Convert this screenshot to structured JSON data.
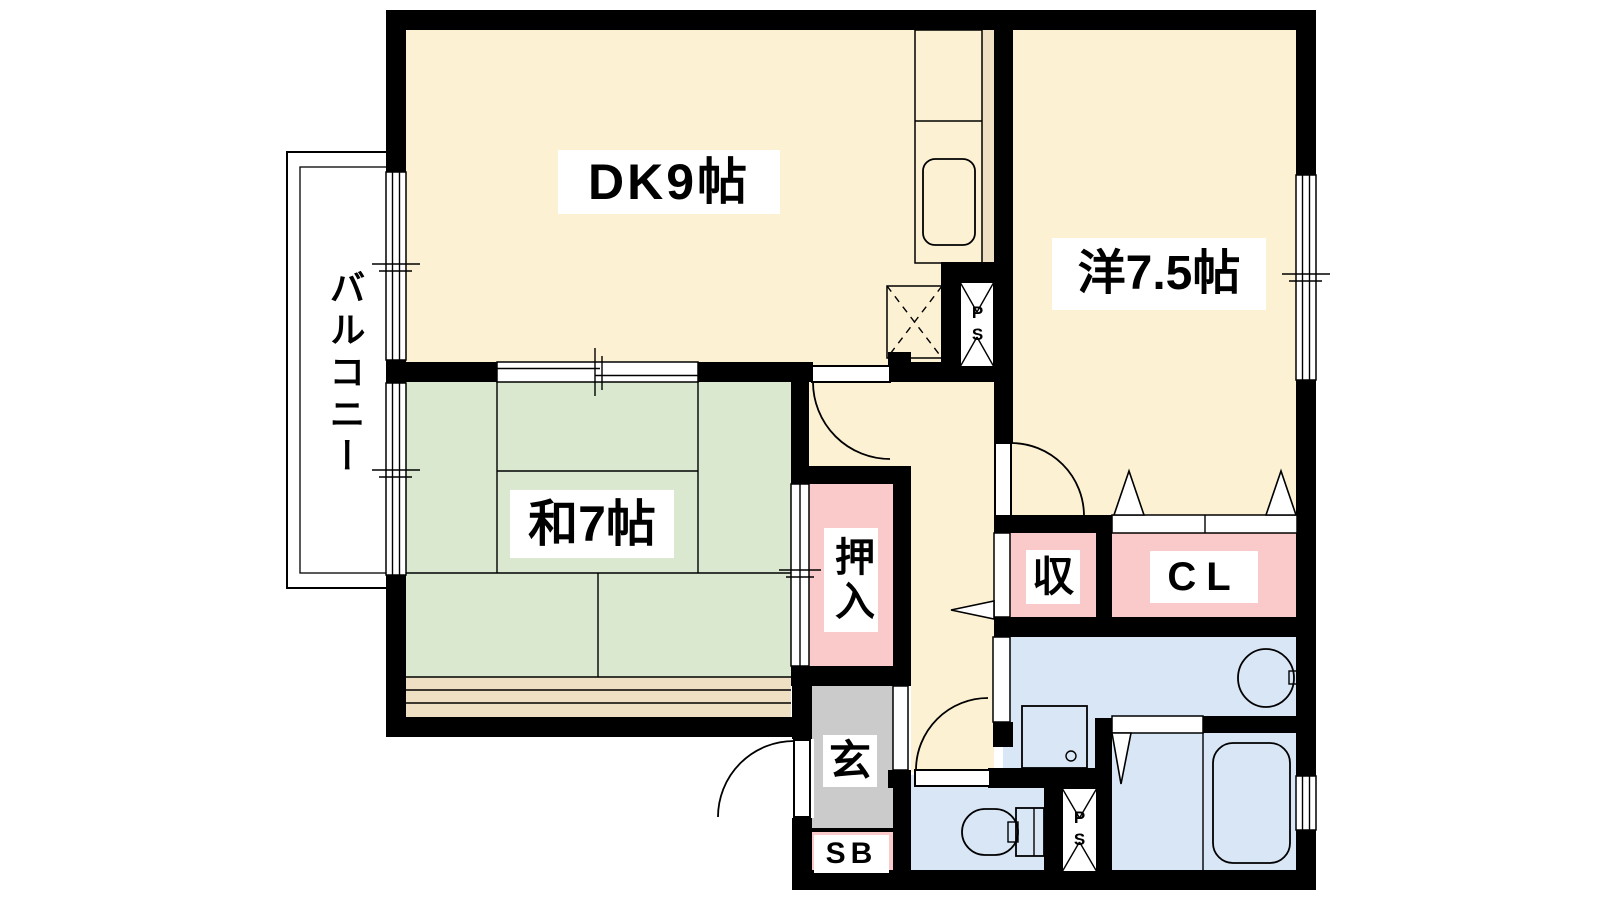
{
  "title": "2DK間取り図",
  "palette": {
    "floor_cream": "#FCF1D3",
    "tatami_green": "#D9E8CF",
    "closet_pink": "#FAC9C9",
    "water_blue": "#D8E6F6",
    "fixture_blue": "#E7F0FB",
    "counter_purple": "#E3D7F0",
    "sink_purple": "#EFE9F8",
    "genkan_gray": "#CBCBCB",
    "balcony_gray": "#D8D8D8",
    "deck_tan": "#F0E0C3",
    "wall_black": "#000000",
    "bg_white": "#FFFFFF"
  },
  "labels": {
    "dk": "DK9帖",
    "western": "洋7.5帖",
    "japanese": "和7帖",
    "balcony": "バルコニー",
    "oshiire": "押入",
    "storage": "収",
    "closet": "CL",
    "genkan": "玄",
    "shoebox": "SB",
    "pipe_space_upper": "PS",
    "pipe_space_lower": "PS"
  },
  "rooms": [
    {
      "id": "dk",
      "label": "DK9帖",
      "tatami": 9
    },
    {
      "id": "western",
      "label": "洋7.5帖",
      "tatami": 7.5
    },
    {
      "id": "japanese",
      "label": "和7帖",
      "tatami": 7
    },
    {
      "id": "balcony",
      "label": "バルコニー"
    },
    {
      "id": "oshiire",
      "label": "押入"
    },
    {
      "id": "storage",
      "label": "収"
    },
    {
      "id": "closet",
      "label": "CL"
    },
    {
      "id": "genkan",
      "label": "玄"
    },
    {
      "id": "shoebox",
      "label": "SB"
    },
    {
      "id": "pipe_space_upper",
      "label": "PS"
    },
    {
      "id": "pipe_space_lower",
      "label": "PS"
    }
  ]
}
